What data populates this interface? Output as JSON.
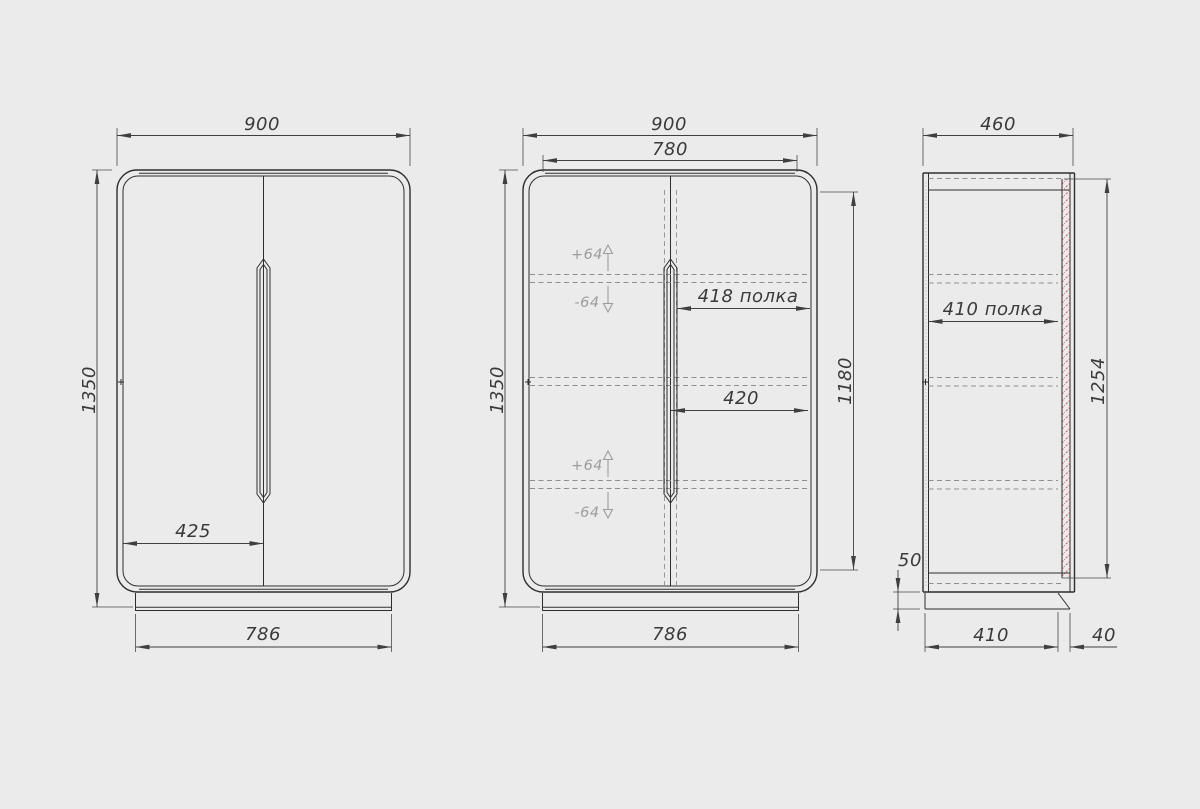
{
  "meta": {
    "drawing_type": "furniture technical drawing - wardrobe, three orthographic views",
    "background_color": "#ebebeb",
    "line_color": "#2e2e2e",
    "dimension_color": "#3f3f3f",
    "ghost_annotation_color": "#9c9c9c",
    "back_panel_hatch_color": "#cf5f66"
  },
  "views": {
    "front_exterior": {
      "dims": {
        "width": "900",
        "height": "1350",
        "handle_offset": "425",
        "base_width": "786"
      }
    },
    "front_interior": {
      "dims": {
        "width": "900",
        "opening_width": "780",
        "height": "1350",
        "interior_height": "1180",
        "shelf_width": "418 полка",
        "half_width": "420",
        "base_width": "786"
      },
      "adjust": {
        "up": "+64",
        "down": "-64"
      }
    },
    "side": {
      "dims": {
        "depth": "460",
        "shelf_depth": "410 полка",
        "interior_height": "1254",
        "plinth_height": "50",
        "base_depth": "410",
        "back_offset": "40"
      }
    }
  }
}
